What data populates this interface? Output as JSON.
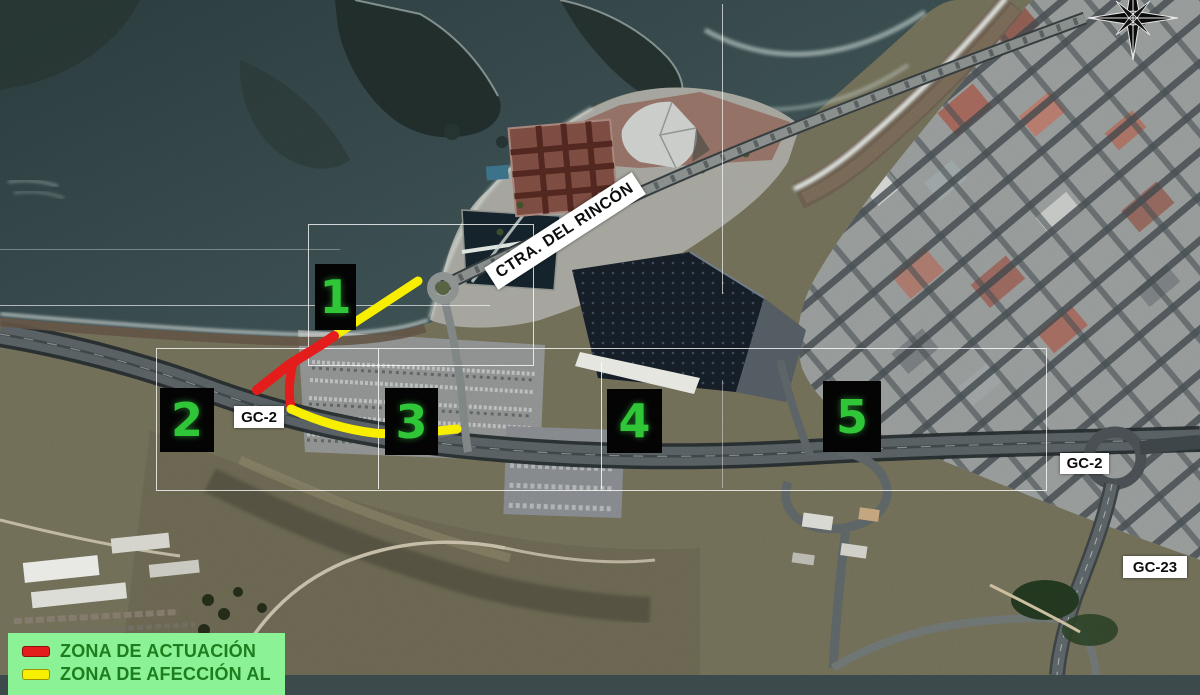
{
  "map": {
    "title": "Aerial plan of El Rincón coastal works, GC-2",
    "road_labels": {
      "ctra_rincon": "CTRA. DEL RINCÓN",
      "gc2_west": "GC-2",
      "gc2_east": "GC-2",
      "gc23": "GC-23"
    }
  },
  "markers": [
    {
      "label": "1"
    },
    {
      "label": "2"
    },
    {
      "label": "3"
    },
    {
      "label": "4"
    },
    {
      "label": "5"
    }
  ],
  "marker_style": {
    "background": "#040404",
    "digit_color": "#2fc737"
  },
  "legend": {
    "background": "#8cf296",
    "text_color": "#1e7e1e",
    "items": [
      {
        "label": "ZONA DE ACTUACIÓN",
        "color": "#e51c1c"
      },
      {
        "label": "ZONA DE AFECCIÓN AL",
        "color": "#f8ee00"
      }
    ]
  },
  "compass": {
    "icon": "compass-rose"
  }
}
